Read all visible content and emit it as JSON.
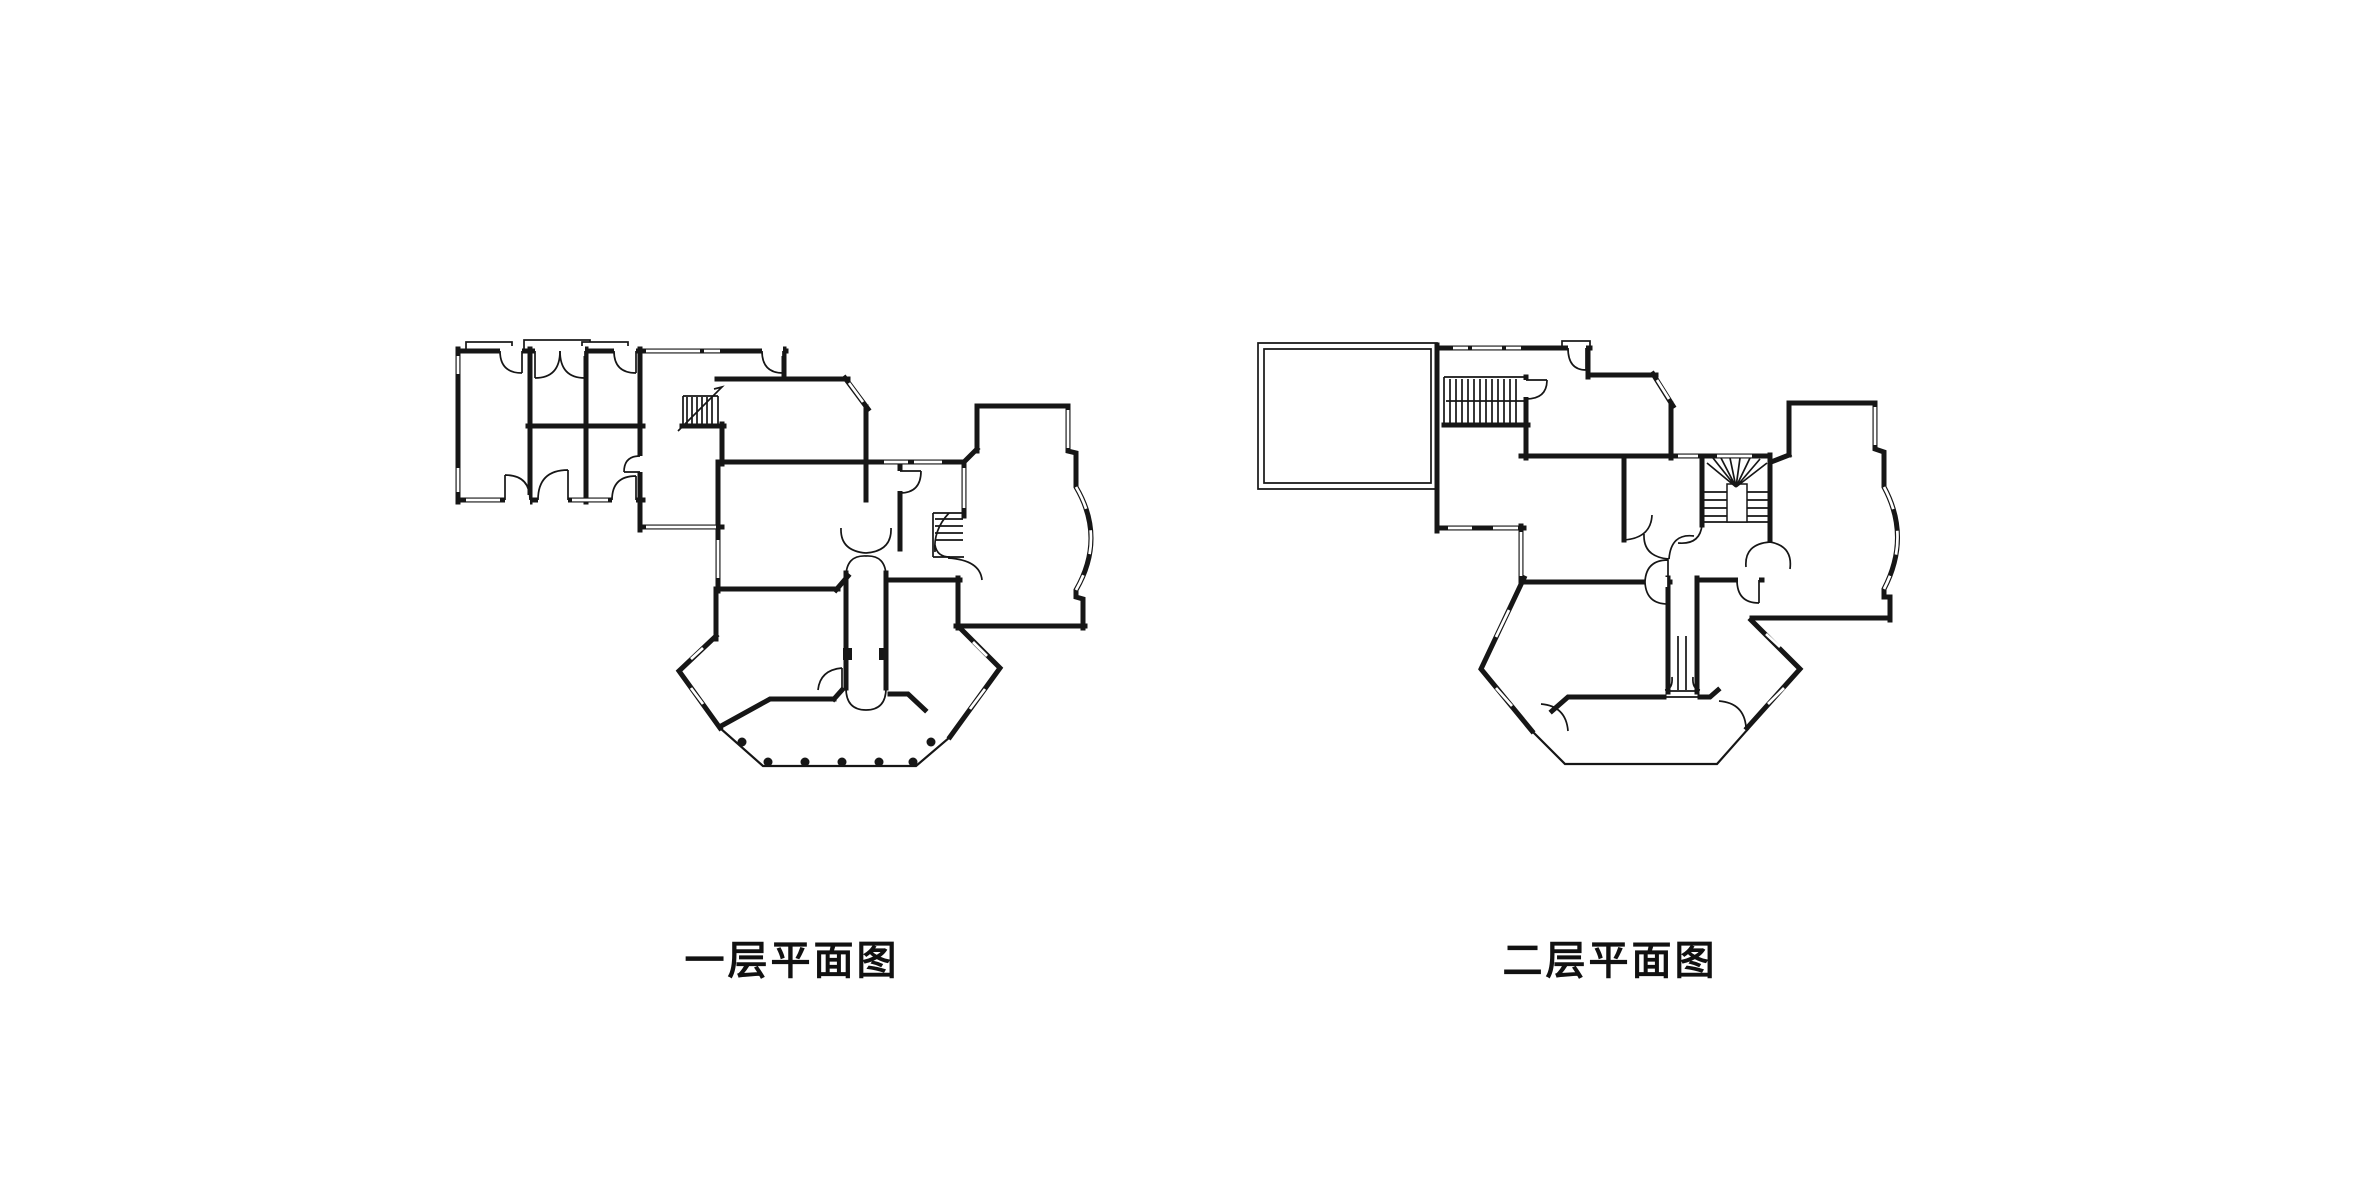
{
  "page": {
    "background_color": "#ffffff",
    "ink_color": "#161616",
    "type": "architectural floor plan sheet"
  },
  "figures": [
    {
      "id": "first-floor",
      "caption": "一层平面图",
      "drawing": "floor plan with left bedroom wing, central hall with straight stair, winder stair, curved bay-window room on right, hexagonal sunroom and entry porch",
      "porch_column_count": 7
    },
    {
      "id": "second-floor",
      "caption": "二层平面图",
      "drawing": "floor plan with large open terrace at top-left, double-flight stair, winder stair, curved bay-window room on right and hexagonal room with balcony below"
    }
  ]
}
